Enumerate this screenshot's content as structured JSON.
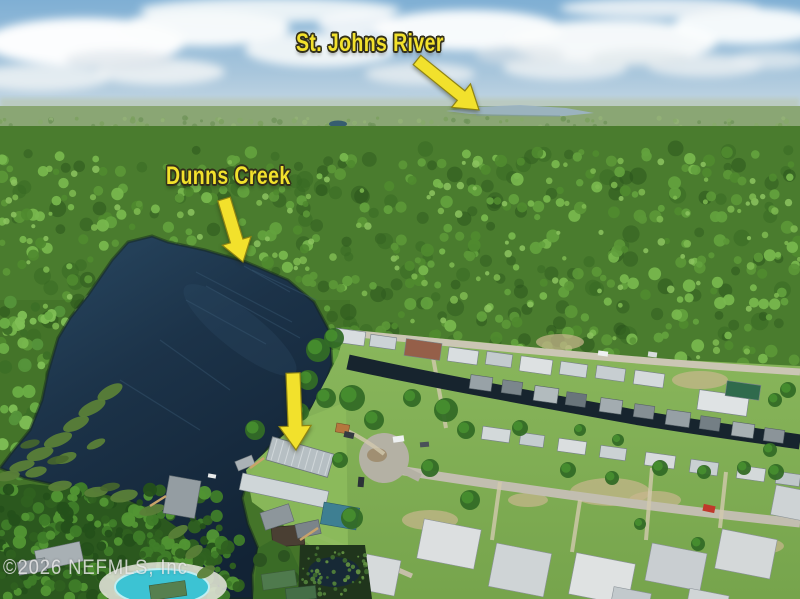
{
  "annotations": {
    "accent_color": "#F2E12C",
    "outline_color": "#33301A",
    "labels": [
      {
        "id": "st-johns-river",
        "text": "St. Johns River"
      },
      {
        "id": "dunns-creek",
        "text": "Dunns Creek"
      }
    ],
    "arrows": [
      "st-johns-river-arrow",
      "dunns-creek-arrow",
      "subject-property-arrow"
    ]
  },
  "watermark": {
    "text": "©2026 NEFMLS, Inc",
    "color": "#E9E9E9"
  },
  "palette": {
    "sky_top": "#7FAFD4",
    "sky_horizon": "#C6D8E4",
    "forest": "#4E8030",
    "creek_water": "#1B3246",
    "distant_river": "#9CB3C2",
    "lawn": "#86B35A",
    "road": "#C9C4B2",
    "pool": "#3EC6D6",
    "red_car": "#C0392B"
  }
}
